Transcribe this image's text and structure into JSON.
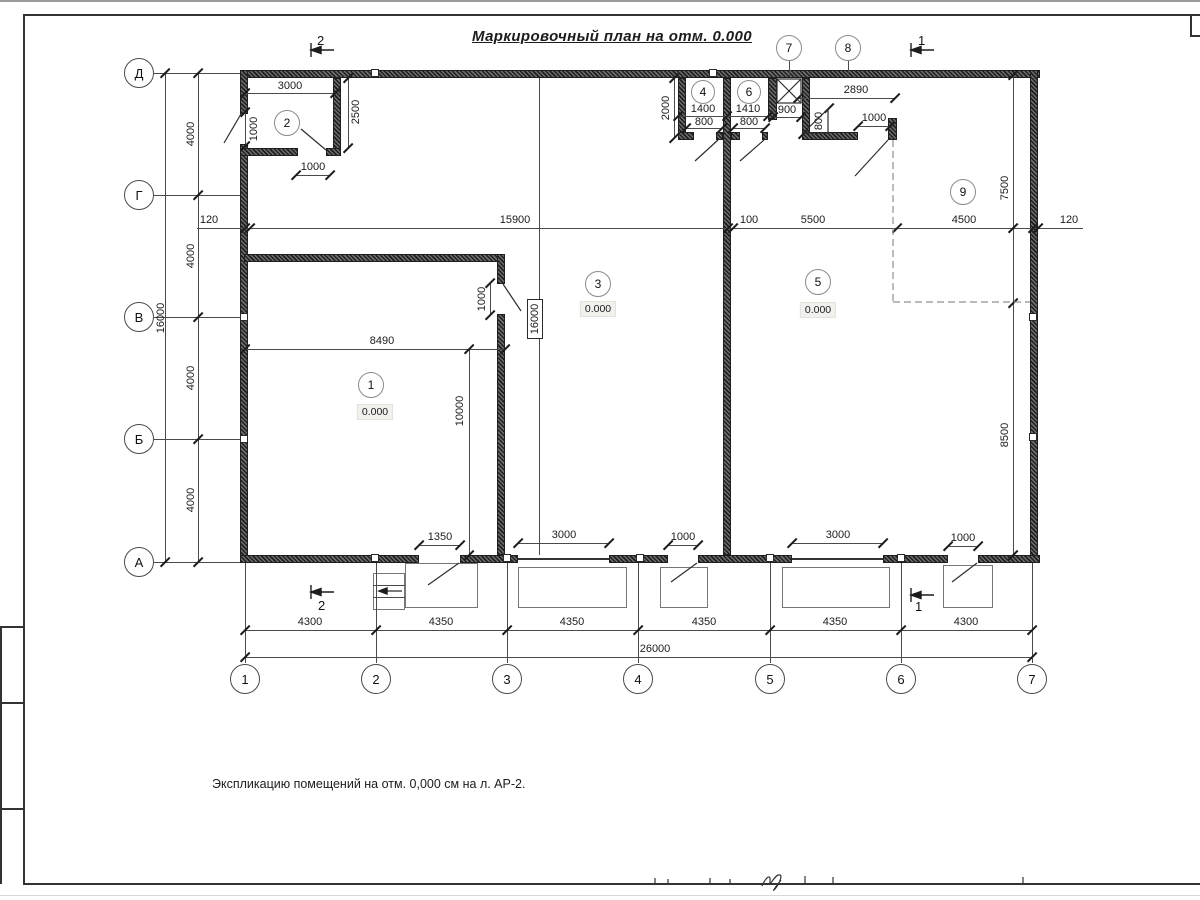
{
  "title": "Маркировочный план на отм. 0.000",
  "note": "Экспликацию помещений на отм. 0,000 см на л. АР-2.",
  "axes": {
    "horizontal": [
      "1",
      "2",
      "3",
      "4",
      "5",
      "6",
      "7"
    ],
    "vertical": [
      "Д",
      "Г",
      "В",
      "Б",
      "А"
    ]
  },
  "sections": {
    "s1": "1",
    "s2": "2"
  },
  "rooms": [
    {
      "number": "1",
      "elevation": "0.000"
    },
    {
      "number": "2"
    },
    {
      "number": "3",
      "elevation": "0.000"
    },
    {
      "number": "4"
    },
    {
      "number": "5",
      "elevation": "0.000"
    },
    {
      "number": "6"
    },
    {
      "number": "7"
    },
    {
      "number": "8"
    },
    {
      "number": "9"
    }
  ],
  "dims": {
    "d100": "100",
    "d120": "120",
    "d800": "800",
    "d900": "900",
    "d1000": "1000",
    "d1350": "1350",
    "d1400": "1400",
    "d1410": "1410",
    "d2000": "2000",
    "d2500": "2500",
    "d2890": "2890",
    "d3000": "3000",
    "d4000": "4000",
    "d4300": "4300",
    "d4350": "4350",
    "d4500": "4500",
    "d5500": "5500",
    "d7500": "7500",
    "d8490": "8490",
    "d8500": "8500",
    "d10000": "10000",
    "d15900": "15900",
    "d16000": "16000",
    "d26000": "26000"
  }
}
